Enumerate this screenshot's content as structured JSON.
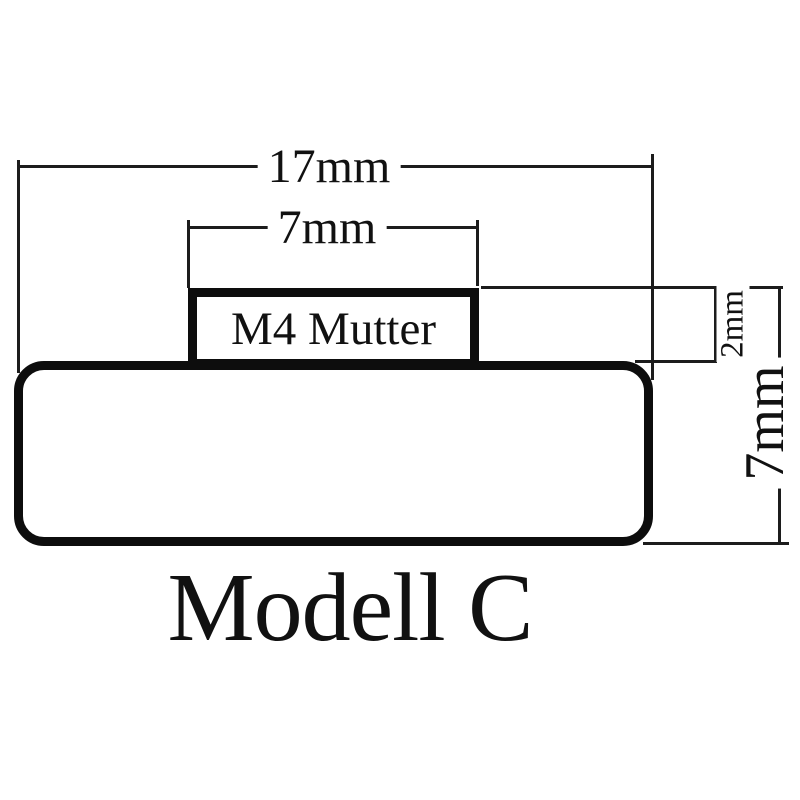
{
  "diagram": {
    "title": "Modell C",
    "nut_label": "M4 Mutter",
    "dimensions": {
      "total_width": "17mm",
      "nut_width": "7mm",
      "nut_height": "2mm",
      "total_height": "7mm"
    },
    "colors": {
      "line": "#1c1c1c",
      "outline": "#0d0d0d",
      "background": "#ffffff"
    }
  }
}
